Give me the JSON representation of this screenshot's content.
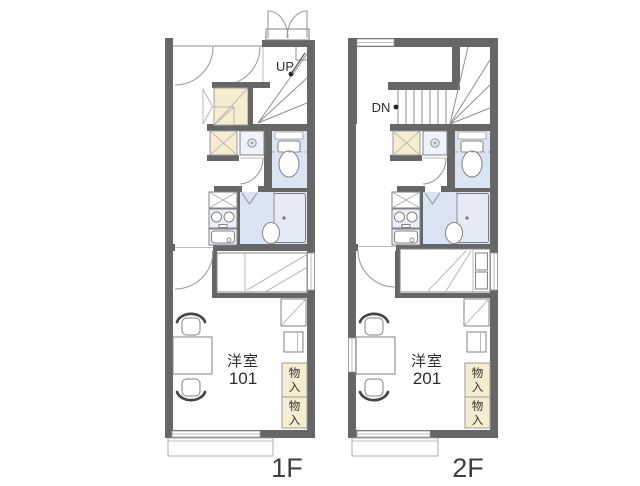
{
  "colors": {
    "wall": "#666666",
    "wet_area_blue": "#dbe4f3",
    "storage_cream": "#f6eccf",
    "fixture_line": "#828282",
    "text": "#2e2e2e"
  },
  "common": {
    "closet_upper": {
      "char1": "物",
      "char2": "入"
    },
    "closet_lower": {
      "char1": "物",
      "char2": "入"
    }
  },
  "floors": {
    "f1": {
      "floor_label": "1F",
      "stair_label": "UP",
      "room": {
        "type_label": "洋室",
        "number": "101"
      }
    },
    "f2": {
      "floor_label": "2F",
      "stair_label": "DN",
      "room": {
        "type_label": "洋室",
        "number": "201"
      }
    }
  }
}
